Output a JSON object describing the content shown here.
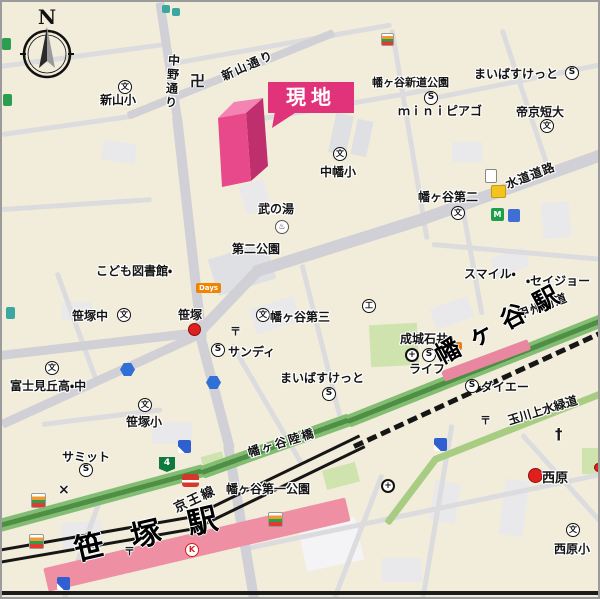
{
  "compass": {
    "label": "N"
  },
  "site": {
    "label": "現地"
  },
  "stations": {
    "sasazuka": "笹塚駅",
    "hatagaya": "幡ヶ谷駅"
  },
  "streets": {
    "shinyama": "新山通り",
    "nakano": "中野通り",
    "suido": "水道道路",
    "koshu": "甲州街道",
    "rikkyo": "幡ヶ谷陸橋",
    "keio": "京王線",
    "tamagawa": "玉川上水緑道"
  },
  "places": {
    "shinyama_sho": "新山小",
    "hatagaya_shindo_koen": "幡ヶ谷新道公園",
    "maibasuketto_north": "まいばすけっと",
    "mini_piago": "ｍｉｎｉピアゴ",
    "teikyo_tandai": "帝京短大",
    "nakahata_sho": "中幡小",
    "hatagaya_daini": "幡ヶ谷第二",
    "take_no_yu": "武の湯",
    "daini_koen": "第二公園",
    "kodomo_toshokan": "こども図書館・",
    "smile": "スマイル・",
    "seijo": "・セイジョー",
    "sasazuka_chu": "笹塚中",
    "sasazuka_crossing": "笹塚",
    "hatagaya_daisan": "幡ヶ谷第三",
    "sandy": "サンディ",
    "seijo_ishii": "成城石井",
    "life": "ライフ",
    "daiei": "ダイエー",
    "fujimigaoka": "富士見丘高・中",
    "maibasuketto_south": "まいばすけっと",
    "sasazuka_sho": "笹塚小",
    "summit": "サミット",
    "hatagaya_daiichi_koen": "幡ヶ谷第一公園",
    "nishihara": "西原",
    "nishihara_sho": "西原小",
    "days_store": "Days"
  },
  "icons": {
    "super_mark": "S",
    "school_mark": "文",
    "temple_mark": "卍",
    "post_mark": "〒",
    "church_mark": "†",
    "police_mark": "×",
    "route_4": "4",
    "hospital_mark": "+",
    "k_store_mark": "K",
    "factory_mark": "工",
    "metro_mark": "M",
    "bath_mark": "♨"
  },
  "colors": {
    "site_pink": "#e0337a",
    "building_front": "#e8498a",
    "building_top": "#f283b2",
    "building_side": "#bf2f6e",
    "station_band": "#ee8fa4",
    "road_green": "#83bd74",
    "map_base": "#f2edda",
    "road_gray": "#d0d0d6",
    "rail_black": "#161616",
    "red_dot": "#e01f1f"
  }
}
